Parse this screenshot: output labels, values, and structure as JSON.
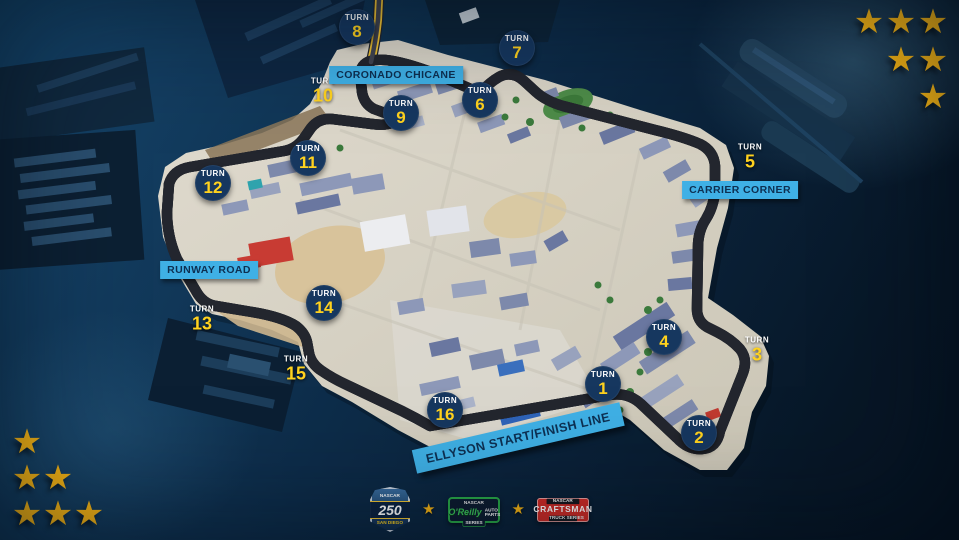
{
  "map": {
    "turn_label": "TURN",
    "turns": [
      {
        "number": "1",
        "x": 603,
        "y": 384,
        "style": "circle"
      },
      {
        "number": "2",
        "x": 699,
        "y": 433,
        "style": "circle"
      },
      {
        "number": "3",
        "x": 757,
        "y": 350,
        "style": "text"
      },
      {
        "number": "4",
        "x": 664,
        "y": 337,
        "style": "circle"
      },
      {
        "number": "5",
        "x": 750,
        "y": 157,
        "style": "text"
      },
      {
        "number": "6",
        "x": 480,
        "y": 100,
        "style": "circle"
      },
      {
        "number": "7",
        "x": 517,
        "y": 48,
        "style": "circle"
      },
      {
        "number": "8",
        "x": 357,
        "y": 27,
        "style": "circle"
      },
      {
        "number": "9",
        "x": 401,
        "y": 113,
        "style": "circle"
      },
      {
        "number": "10",
        "x": 323,
        "y": 91,
        "style": "text"
      },
      {
        "number": "11",
        "x": 308,
        "y": 158,
        "style": "circle"
      },
      {
        "number": "12",
        "x": 213,
        "y": 183,
        "style": "circle"
      },
      {
        "number": "13",
        "x": 202,
        "y": 319,
        "style": "text"
      },
      {
        "number": "14",
        "x": 324,
        "y": 303,
        "style": "circle"
      },
      {
        "number": "15",
        "x": 296,
        "y": 369,
        "style": "text"
      },
      {
        "number": "16",
        "x": 445,
        "y": 410,
        "style": "circle"
      }
    ],
    "labels": [
      {
        "id": "coronado-chicane",
        "text": "CORONADO CHICANE",
        "x": 396,
        "y": 75,
        "rotation": 0,
        "big": false
      },
      {
        "id": "carrier-corner",
        "text": "CARRIER CORNER",
        "x": 740,
        "y": 190,
        "rotation": 0,
        "big": false
      },
      {
        "id": "runway-road",
        "text": "RUNWAY ROAD",
        "x": 209,
        "y": 270,
        "rotation": 0,
        "big": false
      },
      {
        "id": "ellyson-start-finish",
        "text": "ELLYSON START/FINISH LINE",
        "x": 518,
        "y": 438,
        "rotation": -13,
        "big": true
      }
    ]
  },
  "decorations": {
    "top_right_stars": [
      [
        869,
        22
      ],
      [
        901,
        22
      ],
      [
        933,
        22
      ],
      [
        901,
        60
      ],
      [
        933,
        60
      ],
      [
        933,
        97
      ]
    ],
    "bottom_left_stars": [
      [
        27,
        442
      ],
      [
        27,
        478
      ],
      [
        58,
        478
      ],
      [
        27,
        514
      ],
      [
        58,
        514
      ],
      [
        89,
        514
      ]
    ]
  },
  "footer": {
    "race_badge": {
      "top": "NASCAR",
      "number": "250",
      "bottom": "SAN DIEGO"
    },
    "star_icon": "★",
    "oreilly": {
      "brand": "NASCAR",
      "name": "O'Reilly",
      "suffix": "AUTO PARTS",
      "sub": "SERIES"
    },
    "craftsman": {
      "brand": "NASCAR",
      "name": "CRAFTSMAN",
      "sub": "TRUCK SERIES"
    }
  },
  "colors": {
    "water": "#0d2c49",
    "accent_yellow": "#ffd21e",
    "track_yellow": "#f2c433",
    "label_blue": "#3fb0e5",
    "turn_circle_navy": "#16375f",
    "star_gold": "#f6b414",
    "oreilly_green": "#29a747",
    "craftsman_red": "#cf2b26"
  }
}
